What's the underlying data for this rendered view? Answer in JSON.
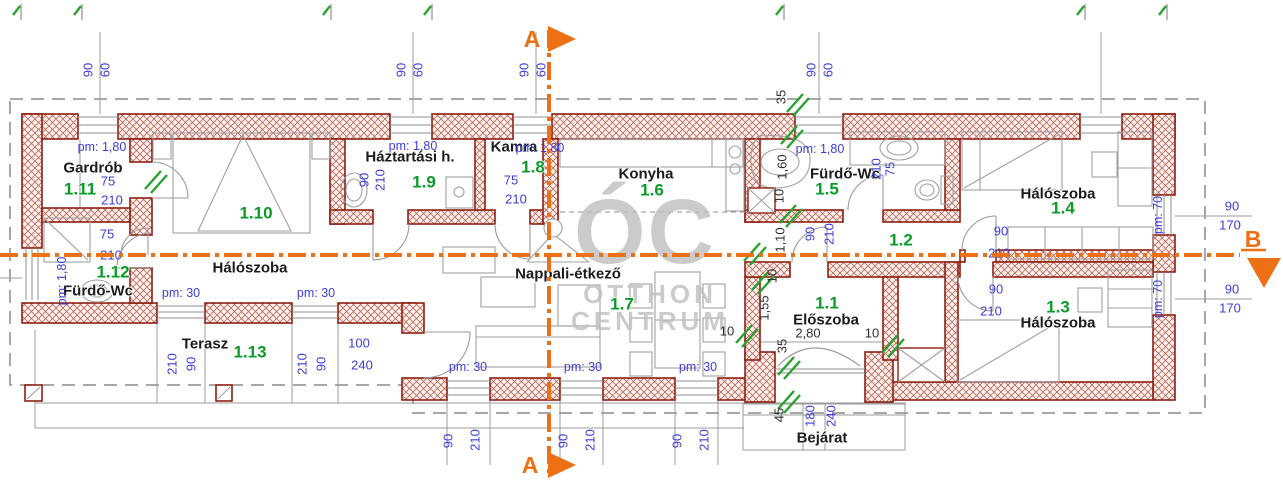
{
  "plan_title": "Floor plan",
  "colors": {
    "wall": "#8e2012",
    "hatch": "#c0685a",
    "dimension_blue": "#3d3dd8",
    "dimension_dark": "#2e2e2e",
    "room_number_green": "#0a9b28",
    "room_name": "#1c1c1c",
    "section_orange": "#ed7014",
    "watermark_gray": "#bdbdbd",
    "new_opening_green": "#28a32e"
  },
  "watermark": {
    "big": "ÓC",
    "line2": "OTTHON",
    "line3": "CENTRUM"
  },
  "sections": {
    "a": "A",
    "b": "B"
  },
  "rooms": [
    {
      "number": "1.1",
      "name": "Előszoba"
    },
    {
      "number": "1.2",
      "name": ""
    },
    {
      "number": "1.3",
      "name": "Hálószoba"
    },
    {
      "number": "1.4",
      "name": "Hálószoba"
    },
    {
      "number": "1.5",
      "name": "Fürdő-Wc"
    },
    {
      "number": "1.6",
      "name": "Konyha"
    },
    {
      "number": "1.7",
      "name": "Nappali-étkező"
    },
    {
      "number": "1.8",
      "name": "Kamra"
    },
    {
      "number": "1.9",
      "name": "Háztartási h."
    },
    {
      "number": "1.10",
      "name": "Hálószoba"
    },
    {
      "number": "1.11",
      "name": "Gardrób"
    },
    {
      "number": "1.12",
      "name": "Fürdő-Wc"
    },
    {
      "number": "1.13",
      "name": "Terasz"
    }
  ],
  "entrance_label": "Bejárat",
  "labels": [
    {
      "n": "room-name-gardrob",
      "t": "Gardrób",
      "x": 93,
      "y": 168,
      "c": "name"
    },
    {
      "n": "room-name-haloszoba-1-10",
      "t": "Hálószoba",
      "x": 250,
      "y": 268,
      "c": "name"
    },
    {
      "n": "room-name-furdo-wc-1-12",
      "t": "Fürdő-Wc",
      "x": 98,
      "y": 291,
      "c": "name"
    },
    {
      "n": "room-name-terasz",
      "t": "Terasz",
      "x": 205,
      "y": 344,
      "c": "name"
    },
    {
      "n": "room-name-haztartasi",
      "t": "Háztartási h.",
      "x": 410,
      "y": 157,
      "c": "name"
    },
    {
      "n": "room-name-kamra",
      "t": "Kamra",
      "x": 514,
      "y": 147,
      "c": "name"
    },
    {
      "n": "room-name-konyha",
      "t": "Konyha",
      "x": 646,
      "y": 174,
      "c": "name"
    },
    {
      "n": "room-name-nappali",
      "t": "Nappali-étkező",
      "x": 568,
      "y": 274,
      "c": "name"
    },
    {
      "n": "room-name-furdo-wc-1-5",
      "t": "Fürdő-Wc",
      "x": 845,
      "y": 174,
      "c": "name"
    },
    {
      "n": "room-name-haloszoba-1-4",
      "t": "Hálószoba",
      "x": 1058,
      "y": 194,
      "c": "name"
    },
    {
      "n": "room-name-eloszoba",
      "t": "Előszoba",
      "x": 826,
      "y": 320,
      "c": "name"
    },
    {
      "n": "room-name-haloszoba-1-3",
      "t": "Hálószoba",
      "x": 1058,
      "y": 323,
      "c": "name"
    },
    {
      "n": "entrance-label",
      "t": "Bejárat",
      "x": 822,
      "y": 438,
      "c": "name"
    },
    {
      "n": "room-num-1-11",
      "t": "1.11",
      "x": 80,
      "y": 189,
      "c": "num"
    },
    {
      "n": "room-num-1-10",
      "t": "1.10",
      "x": 256,
      "y": 213,
      "c": "num"
    },
    {
      "n": "room-num-1-12",
      "t": "1.12",
      "x": 113,
      "y": 272,
      "c": "num"
    },
    {
      "n": "room-num-1-13",
      "t": "1.13",
      "x": 250,
      "y": 352,
      "c": "num"
    },
    {
      "n": "room-num-1-9",
      "t": "1.9",
      "x": 424,
      "y": 182,
      "c": "num"
    },
    {
      "n": "room-num-1-8",
      "t": "1.8",
      "x": 533,
      "y": 167,
      "c": "num"
    },
    {
      "n": "room-num-1-6",
      "t": "1.6",
      "x": 652,
      "y": 190,
      "c": "num"
    },
    {
      "n": "room-num-1-7",
      "t": "1.7",
      "x": 622,
      "y": 304,
      "c": "num"
    },
    {
      "n": "room-num-1-5",
      "t": "1.5",
      "x": 827,
      "y": 189,
      "c": "num"
    },
    {
      "n": "room-num-1-2",
      "t": "1.2",
      "x": 901,
      "y": 240,
      "c": "num"
    },
    {
      "n": "room-num-1-4",
      "t": "1.4",
      "x": 1063,
      "y": 208,
      "c": "num"
    },
    {
      "n": "room-num-1-1",
      "t": "1.1",
      "x": 827,
      "y": 303,
      "c": "num"
    },
    {
      "n": "room-num-1-3",
      "t": "1.3",
      "x": 1058,
      "y": 307,
      "c": "num"
    },
    {
      "t": "pm: 1,80",
      "x": 102,
      "y": 147,
      "c": "pm"
    },
    {
      "t": "pm: 1,80",
      "x": 413,
      "y": 146,
      "c": "pm"
    },
    {
      "t": "pm: 1,80",
      "x": 540,
      "y": 148,
      "c": "pm"
    },
    {
      "t": "pm: 1,80",
      "x": 820,
      "y": 149,
      "c": "pm"
    },
    {
      "t": "pm: 1,80",
      "x": 62,
      "y": 281,
      "c": "pm",
      "r": -90
    },
    {
      "t": "pm: 30",
      "x": 181,
      "y": 293,
      "c": "pm"
    },
    {
      "t": "pm: 30",
      "x": 316,
      "y": 293,
      "c": "pm"
    },
    {
      "t": "pm: 30",
      "x": 468,
      "y": 367,
      "c": "pm"
    },
    {
      "t": "pm: 30",
      "x": 583,
      "y": 367,
      "c": "pm"
    },
    {
      "t": "pm: 30",
      "x": 698,
      "y": 367,
      "c": "pm"
    },
    {
      "t": "pm: 70",
      "x": 1158,
      "y": 215,
      "c": "pm",
      "r": -90
    },
    {
      "t": "pm: 70",
      "x": 1158,
      "y": 299,
      "c": "pm",
      "r": -90
    },
    {
      "t": "75",
      "x": 108,
      "y": 181,
      "c": "dim"
    },
    {
      "t": "210",
      "x": 112,
      "y": 200,
      "c": "dim"
    },
    {
      "t": "75",
      "x": 107,
      "y": 234,
      "c": "dim"
    },
    {
      "t": "210",
      "x": 111,
      "y": 255,
      "c": "dim"
    },
    {
      "t": "75",
      "x": 511,
      "y": 180,
      "c": "dim"
    },
    {
      "t": "210",
      "x": 516,
      "y": 199,
      "c": "dim"
    },
    {
      "t": "100",
      "x": 359,
      "y": 343,
      "c": "dim"
    },
    {
      "t": "240",
      "x": 362,
      "y": 365,
      "c": "dim"
    },
    {
      "t": "90",
      "x": 1001,
      "y": 231,
      "c": "dim"
    },
    {
      "t": "210",
      "x": 999,
      "y": 253,
      "c": "dim"
    },
    {
      "t": "90",
      "x": 996,
      "y": 289,
      "c": "dim"
    },
    {
      "t": "210",
      "x": 991,
      "y": 311,
      "c": "dim"
    },
    {
      "t": "90",
      "x": 1232,
      "y": 206,
      "c": "dim"
    },
    {
      "t": "170",
      "x": 1230,
      "y": 225,
      "c": "dim"
    },
    {
      "t": "90",
      "x": 1232,
      "y": 289,
      "c": "dim"
    },
    {
      "t": "170",
      "x": 1230,
      "y": 308,
      "c": "dim"
    },
    {
      "t": "90",
      "x": 88,
      "y": 70,
      "c": "dim",
      "r": -90
    },
    {
      "t": "60",
      "x": 105,
      "y": 70,
      "c": "dim",
      "r": -90
    },
    {
      "t": "90",
      "x": 401,
      "y": 70,
      "c": "dim",
      "r": -90
    },
    {
      "t": "60",
      "x": 418,
      "y": 70,
      "c": "dim",
      "r": -90
    },
    {
      "t": "90",
      "x": 524,
      "y": 70,
      "c": "dim",
      "r": -90
    },
    {
      "t": "60",
      "x": 541,
      "y": 70,
      "c": "dim",
      "r": -90
    },
    {
      "t": "90",
      "x": 811,
      "y": 70,
      "c": "dim",
      "r": -90
    },
    {
      "t": "60",
      "x": 828,
      "y": 70,
      "c": "dim",
      "r": -90
    },
    {
      "t": "210",
      "x": 172,
      "y": 364,
      "c": "dim",
      "r": -90
    },
    {
      "t": "90",
      "x": 191,
      "y": 364,
      "c": "dim",
      "r": -90
    },
    {
      "t": "210",
      "x": 302,
      "y": 364,
      "c": "dim",
      "r": -90
    },
    {
      "t": "90",
      "x": 321,
      "y": 364,
      "c": "dim",
      "r": -90
    },
    {
      "t": "90",
      "x": 364,
      "y": 180,
      "c": "dim",
      "r": -90
    },
    {
      "t": "210",
      "x": 380,
      "y": 180,
      "c": "dim",
      "r": -90
    },
    {
      "t": "90",
      "x": 448,
      "y": 441,
      "c": "dim",
      "r": -90
    },
    {
      "t": "210",
      "x": 475,
      "y": 440,
      "c": "dim",
      "r": -90
    },
    {
      "t": "90",
      "x": 563,
      "y": 441,
      "c": "dim",
      "r": -90
    },
    {
      "t": "210",
      "x": 590,
      "y": 440,
      "c": "dim",
      "r": -90
    },
    {
      "t": "90",
      "x": 677,
      "y": 441,
      "c": "dim",
      "r": -90
    },
    {
      "t": "210",
      "x": 704,
      "y": 440,
      "c": "dim",
      "r": -90
    },
    {
      "t": "90",
      "x": 810,
      "y": 234,
      "c": "dim",
      "r": -90
    },
    {
      "t": "210",
      "x": 829,
      "y": 234,
      "c": "dim",
      "r": -90
    },
    {
      "t": "210",
      "x": 876,
      "y": 169,
      "c": "dim",
      "r": -90
    },
    {
      "t": "75",
      "x": 890,
      "y": 169,
      "c": "dim",
      "r": -90
    },
    {
      "t": "180",
      "x": 810,
      "y": 416,
      "c": "dim",
      "r": -90
    },
    {
      "t": "240",
      "x": 831,
      "y": 416,
      "c": "dim",
      "r": -90
    },
    {
      "t": "35",
      "x": 781,
      "y": 97,
      "c": "dimd",
      "r": -90
    },
    {
      "t": "1,60",
      "x": 782,
      "y": 167,
      "c": "dimd",
      "r": -90
    },
    {
      "t": "10",
      "x": 779,
      "y": 196,
      "c": "dimd",
      "r": -90
    },
    {
      "t": "1,10",
      "x": 780,
      "y": 240,
      "c": "dimd",
      "r": -90
    },
    {
      "t": "10",
      "x": 772,
      "y": 276,
      "c": "dimd",
      "r": -90
    },
    {
      "t": "1,55",
      "x": 764,
      "y": 308,
      "c": "dimd",
      "r": -90
    },
    {
      "t": "35",
      "x": 782,
      "y": 346,
      "c": "dimd",
      "r": -90
    },
    {
      "t": "45",
      "x": 779,
      "y": 415,
      "c": "dimd",
      "r": -90
    },
    {
      "t": "2,80",
      "x": 808,
      "y": 333,
      "c": "dimd"
    },
    {
      "t": "10",
      "x": 872,
      "y": 333,
      "c": "dimd"
    },
    {
      "t": "10",
      "x": 727,
      "y": 331,
      "c": "dimd"
    }
  ]
}
